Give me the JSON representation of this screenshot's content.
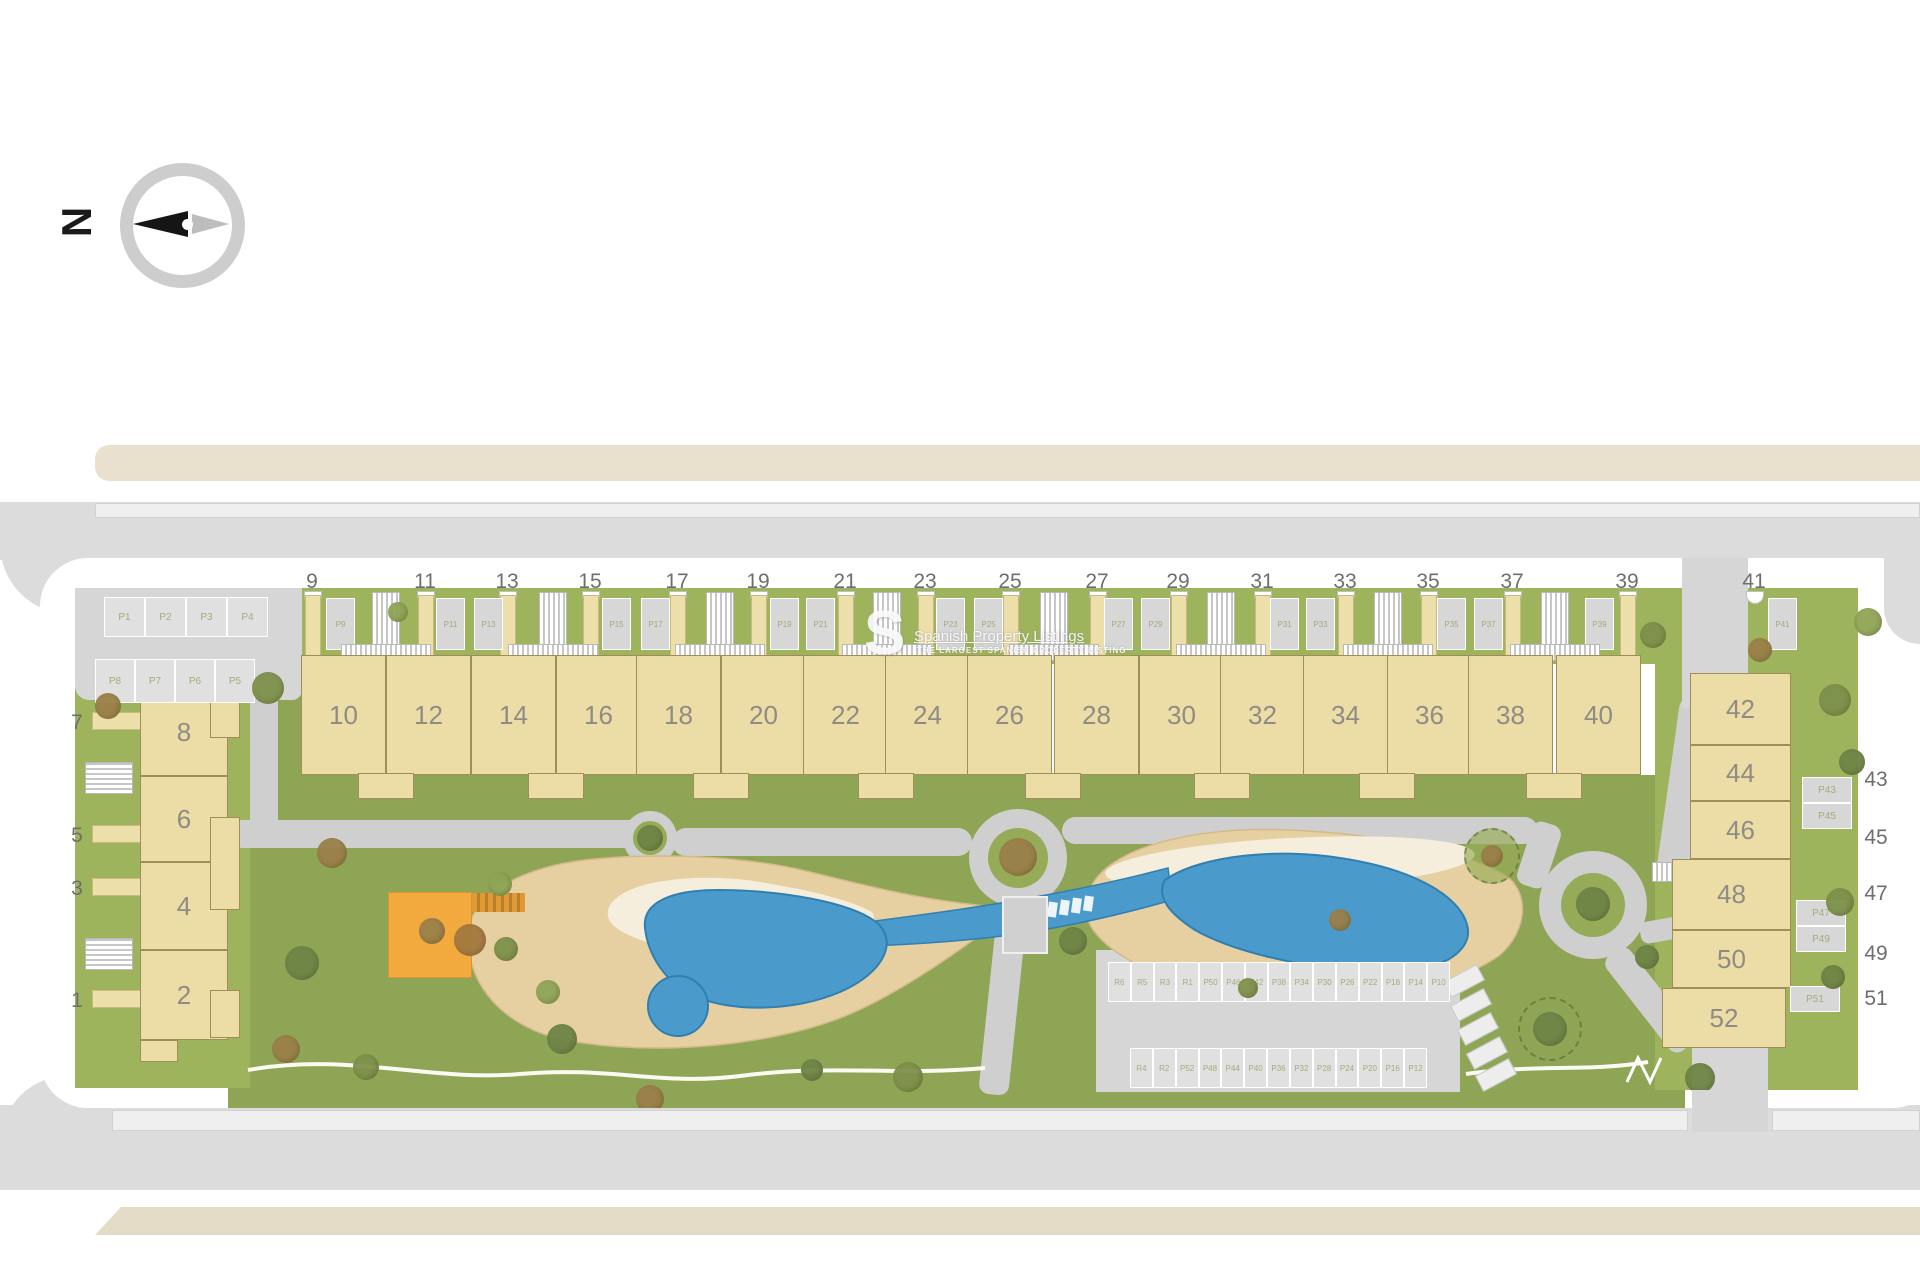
{
  "compass": {
    "label": "N"
  },
  "watermark": {
    "logo": "S",
    "title": "Spanish Property Listings",
    "subtitle": "THE LARGEST SPANISH PROPERTY LISTING"
  },
  "colors": {
    "garden_green": "#9eb45c",
    "park_green": "#8ea556",
    "building_beige": "#ecdca6",
    "pool_blue": "#4a9bcc",
    "sand": "#e6d0a2",
    "cream": "#f5eedc",
    "playground_orange": "#f2a93d",
    "road_gray": "#dcdcdc",
    "road_beige": "#e9e1ce"
  },
  "top_row": {
    "street_numbers": [
      {
        "label": "9",
        "x": 312
      },
      {
        "label": "11",
        "x": 425
      },
      {
        "label": "13",
        "x": 507
      },
      {
        "label": "15",
        "x": 590
      },
      {
        "label": "17",
        "x": 677
      },
      {
        "label": "19",
        "x": 758
      },
      {
        "label": "21",
        "x": 845
      },
      {
        "label": "23",
        "x": 925
      },
      {
        "label": "25",
        "x": 1010
      },
      {
        "label": "27",
        "x": 1097
      },
      {
        "label": "29",
        "x": 1178
      },
      {
        "label": "31",
        "x": 1262
      },
      {
        "label": "33",
        "x": 1345
      },
      {
        "label": "35",
        "x": 1428
      },
      {
        "label": "37",
        "x": 1512
      },
      {
        "label": "39",
        "x": 1627
      },
      {
        "label": "41",
        "x": 1754
      }
    ],
    "buildings": [
      {
        "label": "10",
        "x": 343
      },
      {
        "label": "12",
        "x": 428
      },
      {
        "label": "14",
        "x": 513
      },
      {
        "label": "16",
        "x": 598
      },
      {
        "label": "18",
        "x": 678
      },
      {
        "label": "20",
        "x": 763
      },
      {
        "label": "22",
        "x": 845
      },
      {
        "label": "24",
        "x": 927
      },
      {
        "label": "26",
        "x": 1009
      },
      {
        "label": "28",
        "x": 1096
      },
      {
        "label": "30",
        "x": 1181
      },
      {
        "label": "32",
        "x": 1262
      },
      {
        "label": "34",
        "x": 1345
      },
      {
        "label": "36",
        "x": 1429
      },
      {
        "label": "38",
        "x": 1510
      },
      {
        "label": "40",
        "x": 1598
      }
    ],
    "stalls": [
      {
        "label": "P9",
        "x": 326
      },
      {
        "label": "P11",
        "x": 436
      },
      {
        "label": "P13",
        "x": 474
      },
      {
        "label": "P15",
        "x": 602
      },
      {
        "label": "P17",
        "x": 641
      },
      {
        "label": "P19",
        "x": 770
      },
      {
        "label": "P21",
        "x": 806
      },
      {
        "label": "P23",
        "x": 936
      },
      {
        "label": "P25",
        "x": 974
      },
      {
        "label": "P27",
        "x": 1104
      },
      {
        "label": "P29",
        "x": 1141
      },
      {
        "label": "P31",
        "x": 1270
      },
      {
        "label": "P33",
        "x": 1306
      },
      {
        "label": "P35",
        "x": 1437
      },
      {
        "label": "P37",
        "x": 1474
      },
      {
        "label": "P39",
        "x": 1585
      },
      {
        "label": "P41",
        "x": 1768
      }
    ]
  },
  "left_block": {
    "street_numbers": [
      {
        "label": "7",
        "y": 722
      },
      {
        "label": "5",
        "y": 835
      },
      {
        "label": "3",
        "y": 888
      },
      {
        "label": "1",
        "y": 1000
      }
    ],
    "buildings": [
      {
        "label": "8",
        "y0": 688,
        "y1": 776
      },
      {
        "label": "6",
        "y0": 776,
        "y1": 862
      },
      {
        "label": "4",
        "y0": 862,
        "y1": 950
      },
      {
        "label": "2",
        "y0": 950,
        "y1": 1040
      }
    ],
    "stalls_row1": [
      "P1",
      "P2",
      "P3",
      "P4"
    ],
    "stalls_row2": [
      "P8",
      "P7",
      "P6",
      "P5"
    ]
  },
  "right_block": {
    "street_numbers": [
      {
        "label": "43",
        "y": 779
      },
      {
        "label": "45",
        "y": 837
      },
      {
        "label": "47",
        "y": 893
      },
      {
        "label": "49",
        "y": 953
      },
      {
        "label": "51",
        "y": 998
      }
    ],
    "buildings": [
      {
        "label": "42",
        "y0": 673,
        "y1": 745,
        "x0": 1690,
        "x1": 1791
      },
      {
        "label": "44",
        "y0": 745,
        "y1": 801,
        "x0": 1690,
        "x1": 1791
      },
      {
        "label": "46",
        "y0": 801,
        "y1": 859,
        "x0": 1690,
        "x1": 1791
      },
      {
        "label": "48",
        "y0": 859,
        "y1": 930,
        "x0": 1672,
        "x1": 1791
      },
      {
        "label": "50",
        "y0": 930,
        "y1": 988,
        "x0": 1672,
        "x1": 1791
      },
      {
        "label": "52",
        "y0": 988,
        "y1": 1048,
        "x0": 1662,
        "x1": 1786
      }
    ],
    "stalls": [
      {
        "label": "P43",
        "x": 1802,
        "y": 777
      },
      {
        "label": "P45",
        "x": 1802,
        "y": 803
      },
      {
        "label": "P47",
        "x": 1796,
        "y": 900
      },
      {
        "label": "P49",
        "x": 1796,
        "y": 926
      },
      {
        "label": "P51",
        "x": 1790,
        "y": 986
      }
    ]
  },
  "central_parking": {
    "row1": [
      "R6",
      "R5",
      "R3",
      "R1",
      "P50",
      "P46",
      "P42",
      "P38",
      "P34",
      "P30",
      "P26",
      "P22",
      "P18",
      "P14",
      "P10"
    ],
    "row2": [
      "R4",
      "R2",
      "P52",
      "P48",
      "P44",
      "P40",
      "P36",
      "P32",
      "P28",
      "P24",
      "P20",
      "P16",
      "P12"
    ]
  }
}
